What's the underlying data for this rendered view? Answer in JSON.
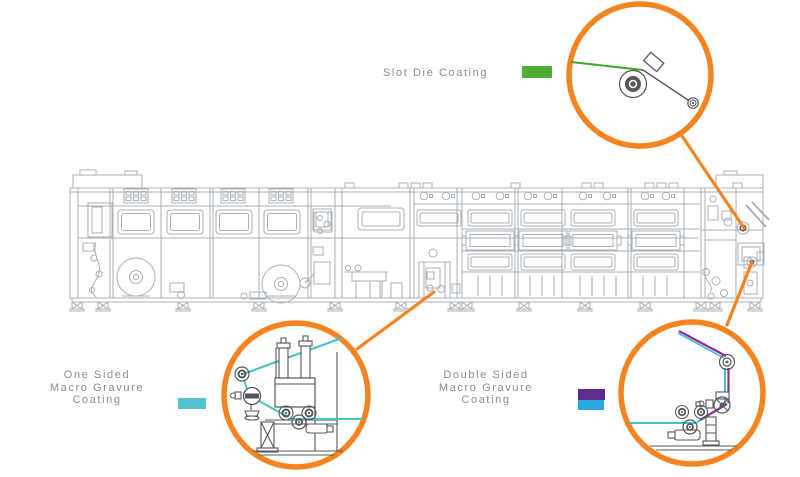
{
  "labels": {
    "slot_die": {
      "text": "Slot Die Coating"
    },
    "one_sided": {
      "lines": [
        "One Sided",
        "Macro Gravure",
        "Coating"
      ]
    },
    "double_sided": {
      "lines": [
        "Double Sided",
        "Macro Gravure",
        "Coating"
      ]
    }
  },
  "swatches": {
    "slot_die": "#4dad33",
    "one_sided": "#55c3cc",
    "double_sided_top": "#5a2d8f",
    "double_sided_bottom": "#2aa9e0"
  },
  "colors": {
    "callout_ring": "#f5831f",
    "connector_line": "#f5831f",
    "machine_line": "#aab0b5",
    "machine_dark": "#54585c",
    "web_green": "#3fa52b",
    "web_cyan": "#45c1cc",
    "web_purple": "#942d96",
    "label_text": "#8a8c8f",
    "background": "#ffffff"
  }
}
